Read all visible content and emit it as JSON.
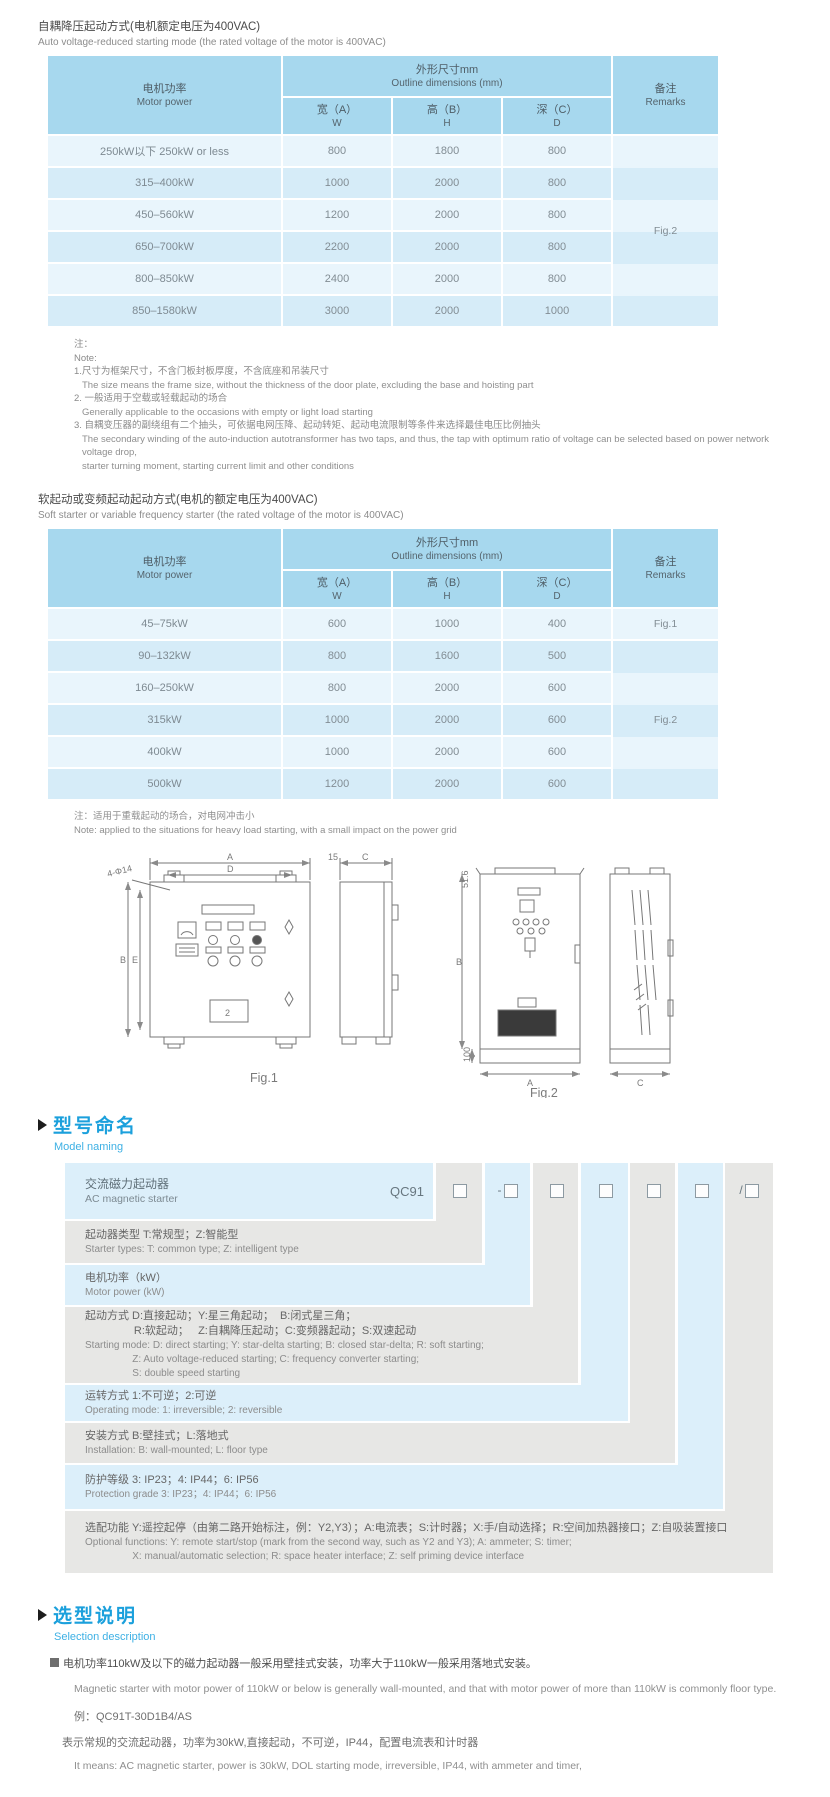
{
  "colors": {
    "accent_blue": "#1ba0dc",
    "table_header": "#a7d8ee",
    "row_light": "#e9f5fc",
    "row_dark": "#d6ecf8",
    "band_gray": "#e7e7e5",
    "band_blue": "#dceffa"
  },
  "section_auto": {
    "title_zh": "自耦降压起动方式(电机额定电压为400VAC)",
    "title_en": "Auto voltage-reduced starting mode (the rated voltage of the motor is 400VAC)",
    "table": {
      "col_motor_zh": "电机功率",
      "col_motor_en": "Motor power",
      "col_outline_zh": "外形尺寸mm",
      "col_outline_en": "Outline dimensions (mm)",
      "col_w_zh": "宽（A）",
      "col_w_en": "W",
      "col_h_zh": "高（B）",
      "col_h_en": "H",
      "col_d_zh": "深（C）",
      "col_d_en": "D",
      "col_rem_zh": "备注",
      "col_rem_en": "Remarks",
      "rows": [
        {
          "power": "250kW以下 250kW or less",
          "w": "800",
          "h": "1800",
          "d": "800"
        },
        {
          "power": "315–400kW",
          "w": "1000",
          "h": "2000",
          "d": "800"
        },
        {
          "power": "450–560kW",
          "w": "1200",
          "h": "2000",
          "d": "800"
        },
        {
          "power": "650–700kW",
          "w": "2200",
          "h": "2000",
          "d": "800"
        },
        {
          "power": "800–850kW",
          "w": "2400",
          "h": "2000",
          "d": "800"
        },
        {
          "power": "850–1580kW",
          "w": "3000",
          "h": "2000",
          "d": "1000"
        }
      ],
      "remark": "Fig.2"
    },
    "notes": {
      "label_zh": "注：",
      "label_en": "Note:",
      "items": [
        {
          "zh": "1.尺寸为框架尺寸，不含门板封板厚度，不含底座和吊装尺寸",
          "en": "The size means the frame size, without the thickness of the door plate, excluding the base and hoisting part"
        },
        {
          "zh": "2. 一般适用于空载或轻载起动的场合",
          "en": "Generally applicable to the occasions with empty or light load starting"
        },
        {
          "zh": "3. 自耦变压器的副绕组有二个抽头，可依据电网压降、起动转矩、起动电流限制等条件来选择最佳电压比例抽头",
          "en": "The secondary winding of the auto-induction autotransformer has two taps, and thus, the tap with optimum ratio of voltage can be selected based on power network voltage drop,\nstarter turning moment, starting current limit and other conditions"
        }
      ]
    }
  },
  "section_soft": {
    "title_zh": "软起动或变频起动起动方式(电机的额定电压为400VAC)",
    "title_en": "Soft starter or variable frequency starter (the rated voltage of the motor is 400VAC)",
    "table": {
      "col_motor_zh": "电机功率",
      "col_motor_en": "Motor power",
      "col_outline_zh": "外形尺寸mm",
      "col_outline_en": "Outline dimensions (mm)",
      "col_w_zh": "宽（A）",
      "col_w_en": "W",
      "col_h_zh": "高（B）",
      "col_h_en": "H",
      "col_d_zh": "深（C）",
      "col_d_en": "D",
      "col_rem_zh": "备注",
      "col_rem_en": "Remarks",
      "rows": [
        {
          "power": "45–75kW",
          "w": "600",
          "h": "1000",
          "d": "400"
        },
        {
          "power": "90–132kW",
          "w": "800",
          "h": "1600",
          "d": "500"
        },
        {
          "power": "160–250kW",
          "w": "800",
          "h": "2000",
          "d": "600"
        },
        {
          "power": "315kW",
          "w": "1000",
          "h": "2000",
          "d": "600"
        },
        {
          "power": "400kW",
          "w": "1000",
          "h": "2000",
          "d": "600"
        },
        {
          "power": "500kW",
          "w": "1200",
          "h": "2000",
          "d": "600"
        }
      ],
      "remark_first": "Fig.1",
      "remark_rest": "Fig.2"
    },
    "note_zh": "注：适用于重载起动的场合，对电网冲击小",
    "note_en": "Note: applied to the situations for heavy load starting, with a small impact on the power grid"
  },
  "figures": {
    "fig1": {
      "caption": "Fig.1",
      "dim_a": "A",
      "dim_d": "D",
      "dim_b": "B",
      "dim_e": "E",
      "dim_c": "C",
      "dim_15": "15",
      "holes": "4-Φ14",
      "panel_label": "2"
    },
    "fig2": {
      "caption": "Fig.2",
      "dim_a": "A",
      "dim_b": "B",
      "dim_c": "C",
      "dim_516": "51.6",
      "dim_100": "100"
    }
  },
  "model_naming": {
    "header_zh": "型号命名",
    "header_en": "Model naming",
    "product_zh": "交流磁力起动器",
    "product_en": "AC magnetic starter",
    "code_prefix": "QC91",
    "box_prefixes": [
      "",
      "-",
      "",
      "",
      "",
      "",
      "/"
    ],
    "rows": [
      {
        "zh": "起动器类型 T:常规型；Z:智能型",
        "en": "Starter types: T: common type; Z: intelligent type"
      },
      {
        "zh": "电机功率（kW）",
        "en": "Motor power (kW)"
      },
      {
        "zh": "起动方式 D:直接起动；Y:星三角起动；  B:闭式星三角；\n                R:软起动；   Z:自耦降压起动；C:变频器起动；S:双速起动",
        "en": "Starting mode: D: direct starting; Y: star-delta starting; B: closed star-delta; R: soft starting;\n                 Z: Auto voltage-reduced starting; C: frequency converter starting;\n                 S: double speed starting"
      },
      {
        "zh": "运转方式 1:不可逆；2:可逆",
        "en": "Operating mode: 1: irreversible; 2: reversible"
      },
      {
        "zh": "安装方式 B:壁挂式；L:落地式",
        "en": "Installation: B: wall-mounted; L: floor type"
      },
      {
        "zh": "防护等级 3: IP23；4: IP44；6: IP56",
        "en": "Protection grade 3: IP23；4: IP44；6: IP56"
      },
      {
        "zh": "选配功能 Y:遥控起停（由第二路开始标注，例：Y2,Y3）；A:电流表；S:计时器；X:手/自动选择；R:空间加热器接口；Z:自吸装置接口",
        "en": "Optional functions: Y: remote start/stop (mark from the second way, such as Y2 and Y3); A: ammeter; S: timer;\n                 X: manual/automatic selection; R: space heater interface; Z: self priming device interface"
      }
    ]
  },
  "selection": {
    "header_zh": "选型说明",
    "header_en": "Selection description",
    "line1_zh": "电机功率110kW及以下的磁力起动器一般采用壁挂式安装，功率大于110kW一般采用落地式安装。",
    "line1_en": "Magnetic starter with motor power of 110kW or below is generally wall-mounted, and that with motor power of more than 110kW is commonly floor type.",
    "example_label": "例：QC91T-30D1B4/AS",
    "example_zh": "表示常规的交流起动器，功率为30kW,直接起动，不可逆，IP44，配置电流表和计时器",
    "example_en": "It means: AC magnetic starter, power is 30kW, DOL starting mode, irreversible, IP44, with ammeter and timer,"
  }
}
